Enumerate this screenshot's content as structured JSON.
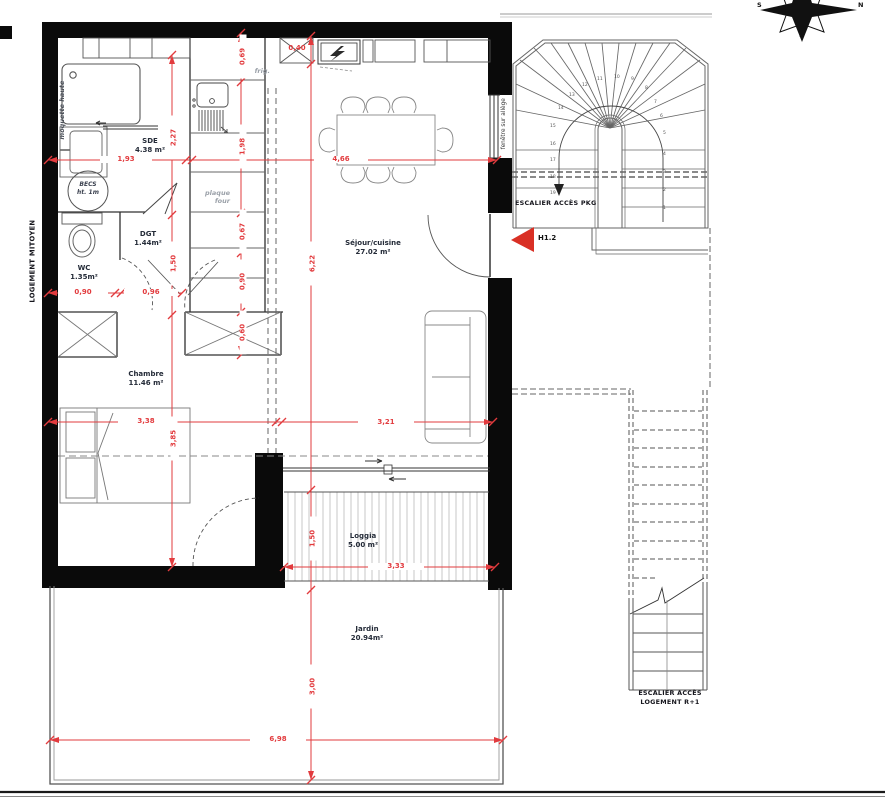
{
  "rooms": {
    "sde": {
      "name": "SDE",
      "area": "4.38 m²"
    },
    "wc": {
      "name": "WC",
      "area": "1.35m²"
    },
    "dgt": {
      "name": "DGT",
      "area": "1.44m²"
    },
    "chambre": {
      "name": "Chambre",
      "area": "11.46 m²"
    },
    "sejour": {
      "name": "Séjour/cuisine",
      "area": "27.02 m²"
    },
    "loggia": {
      "name": "Loggia",
      "area": "5.00 m²"
    },
    "jardin": {
      "name": "Jardin",
      "area": "20.94m²"
    }
  },
  "annotations": {
    "moquette_haute": "moquette haute",
    "becs_line1": "BECS",
    "becs_line2": "ht. 1m",
    "frig": "frig.",
    "plaque": "plaque",
    "four": "four",
    "fenetre_allege": "fenêtre sur allège",
    "logement_mitoyen": "LOGEMENT MITOYEN",
    "escalier_pkg": "ESCALIER ACCÈS PKG",
    "escalier_r1_line1": "ESCALIER ACCÈS",
    "escalier_r1_line2": "LOGEMENT R+1",
    "entry_ref": "H1.2"
  },
  "compass": {
    "north": "N",
    "south": "S",
    "east": "E"
  },
  "dimensions": {
    "sde_width": "1,93",
    "sejour_width_top": "4,66",
    "sde_height": "2,27",
    "dgt_height": "1,50",
    "kitchen_top": "0,69",
    "kitchen_mid": "1,98",
    "kitchen_low": "0,67",
    "kitchen_low2": "0,90",
    "kitchen_low3": "0,60",
    "wc_width": "0,90",
    "dgt_width": "0,96",
    "niche_height": "0,40",
    "sejour_height": "6,22",
    "chambre_width": "3,38",
    "chambre_height": "3,85",
    "sejour_width_low": "3,21",
    "loggia_height": "1,50",
    "loggia_width": "3,33",
    "jardin_height": "3,00",
    "jardin_width": "6,98"
  },
  "colors": {
    "dimension_red": "#e23b3e",
    "wall_black": "#0a0a0a",
    "line_gray": "#666"
  },
  "stairs_pkg_steps": [
    "1",
    "2",
    "3",
    "4",
    "5",
    "6",
    "7",
    "8",
    "9",
    "10",
    "11",
    "12",
    "13",
    "14",
    "15",
    "16",
    "17",
    "18",
    "19"
  ]
}
